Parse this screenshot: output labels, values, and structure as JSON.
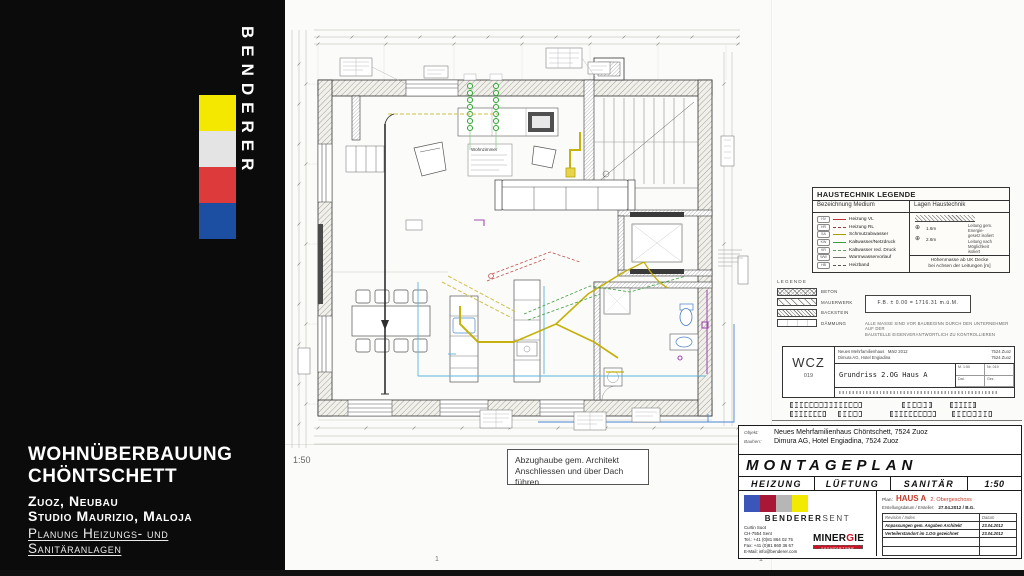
{
  "slide": {
    "brand_vertical": "BENDERER",
    "logo_colors": [
      "#f4e800",
      "#e4e4e4",
      "#dd3a3c",
      "#1c4fa2"
    ],
    "project": {
      "title1": "WOHNÜBERBAUUNG",
      "title2": "CHÖNTSCHETT",
      "sub1": "Zuoz, Neubau",
      "sub2": "Studio Maurizio, Maloja",
      "scope1": "Planung Heizungs- und",
      "scope2": "Sanitäranlagen"
    }
  },
  "plan": {
    "scale_label": "1:50",
    "room_label": "Wohnzimmer",
    "note_line1": "Abzughaube gem. Architekt",
    "note_line2": "Anschliessen und über Dach führen",
    "page_mark_left": "1",
    "page_mark_right": "1"
  },
  "haustechnik_legende": {
    "title": "HAUSTECHNIK LEGENDE",
    "col_medium": "Bezeichnung Medium",
    "col_lagen": "Lagen Haustechnik",
    "items": [
      {
        "tag": "HV",
        "label": "Heizung VL",
        "color": "#c03030",
        "dashed": false
      },
      {
        "tag": "HR",
        "label": "Heizung RL",
        "color": "#8a4040",
        "dashed": true
      },
      {
        "tag": "SA",
        "label": "Schmutzabwasser",
        "color": "#a8a000",
        "dashed": false
      },
      {
        "tag": "KW",
        "label": "Kaltwasser/Netzdruck",
        "color": "#3f9f3f",
        "dashed": false
      },
      {
        "tag": "KR",
        "label": "Kaltwasser red. Druck",
        "color": "#6a9a6a",
        "dashed": true
      },
      {
        "tag": "WW",
        "label": "Warmwasservorlauf",
        "color": "#707070",
        "dashed": false
      },
      {
        "tag": "HB",
        "label": "Heizband",
        "color": "#555555",
        "dashed": true
      }
    ],
    "lagen": {
      "dim1": "1.6m",
      "dim2": "2.6m",
      "sym": "⊕",
      "note1": "Leitung gem. Energie-",
      "note1b": "gesetz isoliert",
      "note2": "Leitung nach Möglichkeit",
      "note2b": "isoliert",
      "footer1": "Höhenmasse ab UK Decke",
      "footer2": "bei Achsen der Leitungen [m]"
    }
  },
  "legende": {
    "title": "LEGENDE",
    "items": [
      {
        "label": "BETON"
      },
      {
        "label": "MAUERWERK"
      },
      {
        "label": "BACKSTEIN"
      },
      {
        "label": "DÄMMUNG"
      }
    ],
    "level_box": "F.B. ± 0.00 = 1716.31 m.ü.M.",
    "note1": "ALLE MASSE SIND VOR BAUBEGINN DURCH DEN UNTERNEHMER AUF DER",
    "note2": "BAUSTELLE EIGENVERANTWORTLICH ZU KONTROLLIEREN"
  },
  "wcz": {
    "code": "WCZ",
    "number": "019",
    "row1a": "Neues Mehrfamilienhaus",
    "row1b": "März 2012",
    "row1c": "7524 Zuoz",
    "row2a": "Dimura AG, Hotel Engiadina",
    "row2c": "7524 Zuoz",
    "drawing": "Grundriss 2.OG  Haus A",
    "c1": "M. 1:50",
    "c2": "Nr. 019",
    "c3": "Dat.",
    "c4": "Gez."
  },
  "title_block": {
    "objekt_label": "Objekt:",
    "objekt": "Neues Mehrfamilienhaus Chöntschett, 7524 Zuoz",
    "bauherr_label": "Bauherr:",
    "bauherr": "Dimura AG, Hotel Engiadina, 7524 Zuoz",
    "title": "MONTAGEPLAN",
    "disc1": "HEIZUNG",
    "disc2": "LÜFTUNG",
    "disc3": "SANITÄR",
    "scale": "1:50",
    "company": {
      "colors": [
        "#3b55b8",
        "#a81836",
        "#b6b6b6",
        "#f2ea00"
      ],
      "name_bold": "BENDERER",
      "name_light": "SENT",
      "addr1": "Curtin Suot",
      "addr2": "CH-7554 Sent",
      "addr3": "Tel.: +41 (0)81 864 02 75",
      "addr4": "Fax: +41 (0)81 860 36 67",
      "addr5": "E-Mail: info@benderer.com",
      "minergie_a": "MINER",
      "minergie_g": "G",
      "minergie_b": "IE",
      "minergie_sub": "FACHPARTNER"
    },
    "plan_info": {
      "plan_label": "Plan:",
      "plan_name": "HAUS A",
      "plan_floor": "2. Obergeschoss",
      "created_label": "Erstellungsdatum / Ersteller:",
      "created_value": "27.04.2012 / B.G.",
      "rev_col1": "Revision / Index",
      "rev_col2": "Datum",
      "rev1_text": "Anpassungen gem. Angaben Architekt",
      "rev1_date": "23.04.2012",
      "rev2_text": "Verteilerstandort im 1.OG gezeichnet",
      "rev2_date": "23.04.2012"
    }
  }
}
